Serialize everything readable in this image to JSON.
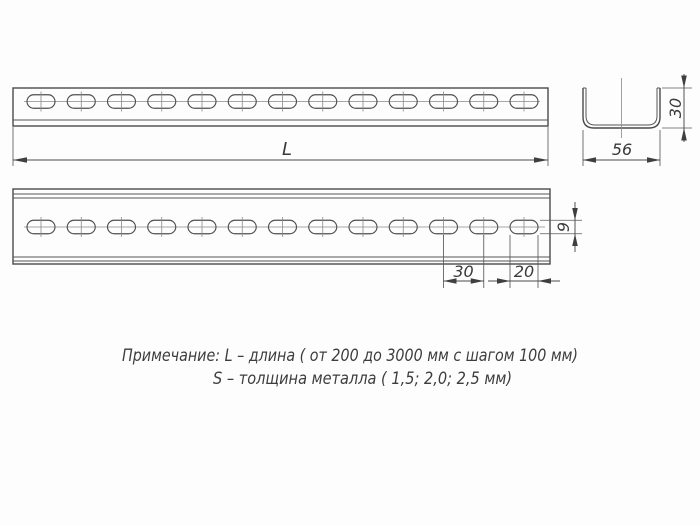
{
  "drawing": {
    "dimensions": {
      "length_label": "L",
      "profile_width": "56",
      "profile_height": "30",
      "slot_width": "9",
      "slot_spacing": "30",
      "slot_length": "20"
    },
    "note": {
      "line1": "Примечание: L – длина ( от 200 до 3000 мм с шагом 100 мм)",
      "line2": "S – толщина металла ( 1,5; 2,0; 2,5 мм)"
    },
    "colors": {
      "line": "#4a4a4a",
      "centerline": "#8a8a8a",
      "text": "#3a3a3a",
      "background": "#ffffff"
    }
  }
}
